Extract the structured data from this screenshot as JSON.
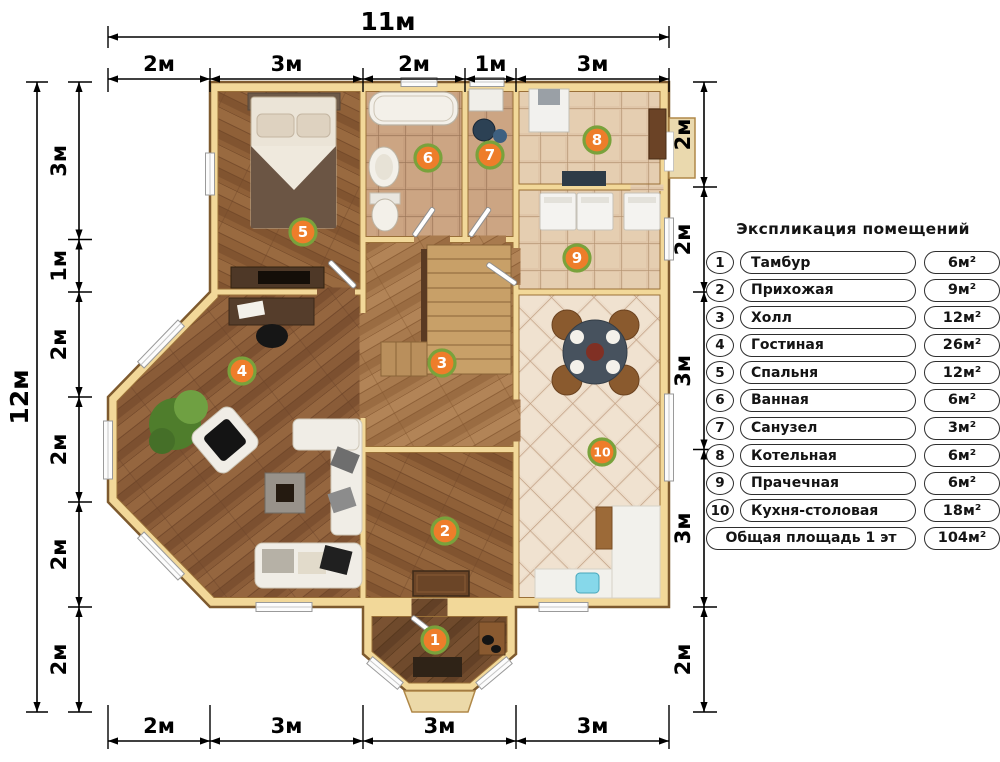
{
  "legend": {
    "title": "Экспликация помещений",
    "rows": [
      {
        "num": "1",
        "name": "Тамбур",
        "area": "6м²"
      },
      {
        "num": "2",
        "name": "Прихожая",
        "area": "9м²"
      },
      {
        "num": "3",
        "name": "Холл",
        "area": "12м²"
      },
      {
        "num": "4",
        "name": "Гостиная",
        "area": "26м²"
      },
      {
        "num": "5",
        "name": "Спальня",
        "area": "12м²"
      },
      {
        "num": "6",
        "name": "Ванная",
        "area": "6м²"
      },
      {
        "num": "7",
        "name": "Санузел",
        "area": "3м²"
      },
      {
        "num": "8",
        "name": "Котельная",
        "area": "6м²"
      },
      {
        "num": "9",
        "name": "Прачечная",
        "area": "6м²"
      },
      {
        "num": "10",
        "name": "Кухня-столовая",
        "area": "18м²"
      }
    ],
    "total_label": "Общая площадь 1 эт",
    "total_area": "104м²"
  },
  "dimensions": {
    "top_total": "11м",
    "top": [
      "2м",
      "3м",
      "2м",
      "1м",
      "3м"
    ],
    "left_total": "12м",
    "left": [
      "3м",
      "1м",
      "2м",
      "2м",
      "2м",
      "2м"
    ],
    "right": [
      "2м",
      "2м",
      "3м",
      "3м",
      "2м"
    ],
    "bottom": [
      "2м",
      "3м",
      "3м",
      "3м"
    ]
  },
  "rooms": [
    "1",
    "2",
    "3",
    "4",
    "5",
    "6",
    "7",
    "8",
    "9",
    "10"
  ],
  "colors": {
    "badge_fill": "#ee7d2a",
    "badge_ring": "#79a23c",
    "wall": "#f2d899"
  }
}
